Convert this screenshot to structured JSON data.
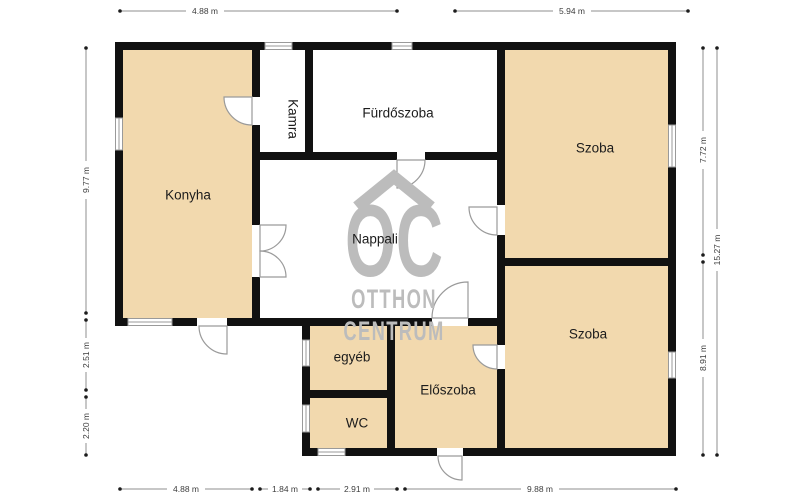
{
  "rooms": {
    "konyha": "Konyha",
    "kamra": "Kamra",
    "furdoszoba": "Fürdőszoba",
    "szoba_top": "Szoba",
    "nappali": "Nappali",
    "szoba_bottom": "Szoba",
    "eloszoba": "Előszoba",
    "egyeb": "egyéb",
    "wc": "WC"
  },
  "dimensions": {
    "top_left": "4.88 m",
    "top_right": "5.94 m",
    "bottom_1": "4.88 m",
    "bottom_2": "1.84 m",
    "bottom_3": "2.91 m",
    "bottom_4": "9.88 m",
    "left_1": "9.77 m",
    "left_2": "2.51 m",
    "left_3": "2.20 m",
    "right_1": "7.72 m",
    "right_2": "8.91 m",
    "right_total": "15.27 m"
  },
  "watermark": {
    "logo": "OC",
    "name_line1": "OTTHON",
    "name_line2": "CENTRUM"
  },
  "colors": {
    "room_fill": "#f2d9ae",
    "wall": "#111111",
    "watermark_gray": "#bcbcbc",
    "dimension_text": "#3d3d3d",
    "door_window_stroke": "#9a9a9a"
  }
}
